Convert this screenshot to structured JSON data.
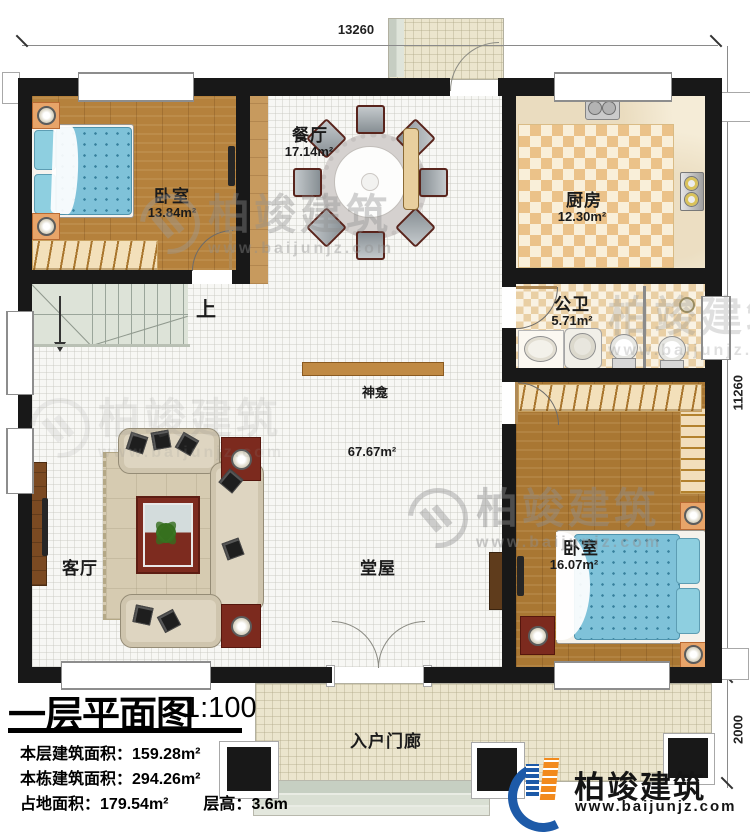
{
  "dimensions": {
    "top": "13260",
    "right": "11260",
    "porch_depth": "2000"
  },
  "rooms": {
    "bedroom1": {
      "name": "卧室",
      "area": "13.84m²"
    },
    "dining": {
      "name": "餐厅",
      "area": "17.14m²"
    },
    "kitchen": {
      "name": "厨房",
      "area": "12.30m²"
    },
    "bathroom": {
      "name": "公卫",
      "area": "5.71m²"
    },
    "bedroom2": {
      "name": "卧室",
      "area": "16.07m²"
    },
    "living": {
      "name": "客厅"
    },
    "hall": {
      "name": "堂屋",
      "area": "67.67m²"
    },
    "entry_porch": {
      "name": "入户门廊"
    }
  },
  "annotations": {
    "stairs_up": "上",
    "shrine": "神龛"
  },
  "title_block": {
    "title": "一层平面图",
    "scale": "1:100",
    "stats": [
      {
        "label": "本层建筑面积：",
        "value": "159.28m²"
      },
      {
        "label": "本栋建筑面积：",
        "value": "294.26m²"
      },
      {
        "label": "占地面积：",
        "value": "179.54m²"
      },
      {
        "label": "层高：",
        "value": "3.6m"
      }
    ]
  },
  "brand": {
    "name": "柏竣建筑",
    "website": "www.baijunjz.com"
  },
  "watermark": {
    "name": "柏竣建筑",
    "website": "www.baijunjz.com"
  },
  "colors": {
    "wall": "#181818",
    "wood_floor": "#b5813c",
    "tile_floor": "#f7f7f4",
    "kitchen_checker": "#ebc289",
    "porch_tile": "#ebe5cd",
    "bed_blue": "#7fc2d9",
    "accent_red": "#7c2a1e",
    "brand_blue": "#1d5aa8",
    "brand_orange": "#f28a1d"
  }
}
